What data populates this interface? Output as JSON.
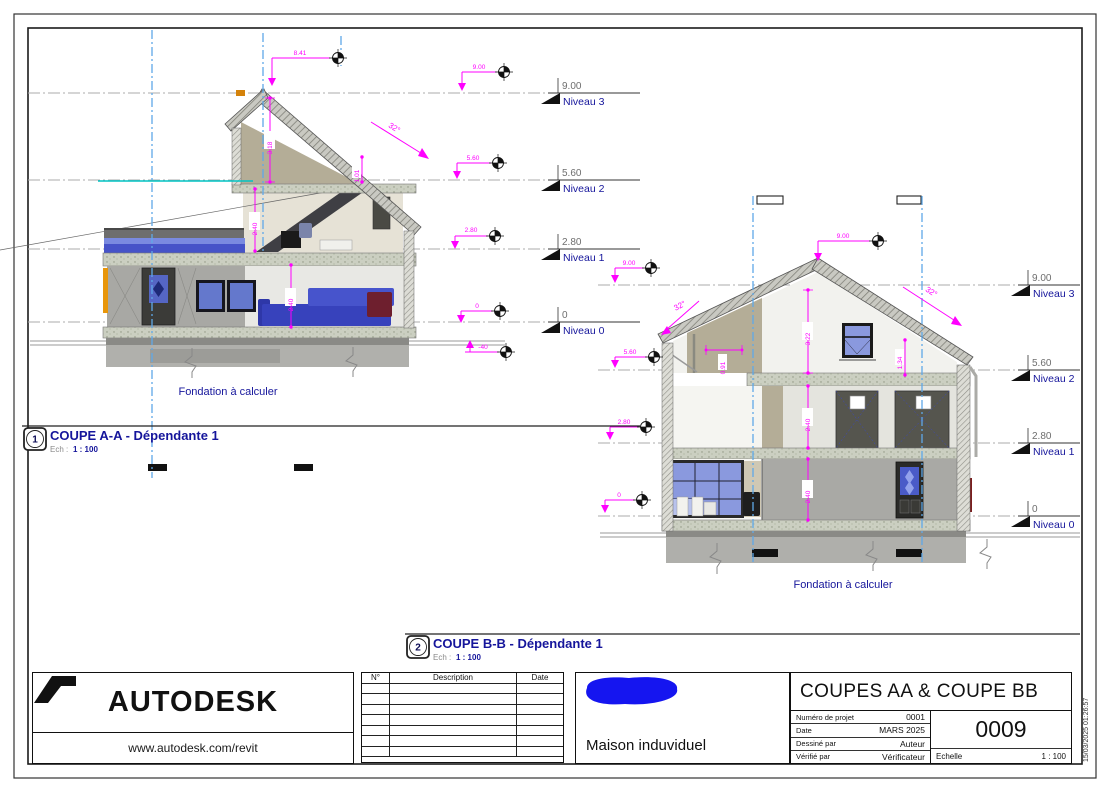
{
  "sheet": {
    "print_stamp": "15/03/2025 01:26:57"
  },
  "levels": [
    {
      "elev": "9.00",
      "label": "Niveau 3"
    },
    {
      "elev": "5.60",
      "label": "Niveau 2"
    },
    {
      "elev": "2.80",
      "label": "Niveau 1"
    },
    {
      "elev": "0",
      "label": "Niveau 0"
    }
  ],
  "coupe_aa": {
    "number": "1",
    "title": "COUPE A-A - Dépendante 1",
    "scale_label": "Ech :",
    "scale": "1 : 100",
    "foundation_note": "Fondation à calculer",
    "slope": "32°",
    "dims": {
      "ridge_height": "8.41",
      "level3": "9.00",
      "level2": "5.60",
      "level1": "2.80",
      "level0": "0",
      "below_grade": "-40",
      "attic_height": "3.18",
      "knee_height": "1.01",
      "floor2_height": "2.40",
      "floor1_height": "2.40"
    }
  },
  "coupe_bb": {
    "number": "2",
    "title": "COUPE B-B - Dépendante 1",
    "scale_label": "Ech :",
    "scale": "1 : 100",
    "foundation_note": "Fondation à calculer",
    "slope_left": "32°",
    "slope_right": "32°",
    "dims": {
      "ridge": "9.00",
      "level3": "9.00",
      "level2": "5.60",
      "level1": "2.80",
      "level0": "0",
      "gable_height": "3.22",
      "window_height": "1.34",
      "knee_height": "0.91",
      "floor2_height": "2.40",
      "floor1_height": "2.40"
    }
  },
  "titleblock": {
    "brand": "AUTODESK",
    "brand_url": "www.autodesk.com/revit",
    "revisions": {
      "headers": [
        "N°",
        "Description",
        "Date"
      ]
    },
    "project_name": "Maison induviduel",
    "sheet_title": "COUPES AA & COUPE BB",
    "fields": [
      {
        "label": "Numéro de projet",
        "value": "0001"
      },
      {
        "label": "Date",
        "value": "MARS 2025"
      },
      {
        "label": "Dessiné par",
        "value": "Auteur"
      },
      {
        "label": "Vérifié par",
        "value": "Vérificateur"
      }
    ],
    "sheet_number": "0009",
    "scale_label": "Echelle",
    "scale_value": "1 : 100"
  }
}
